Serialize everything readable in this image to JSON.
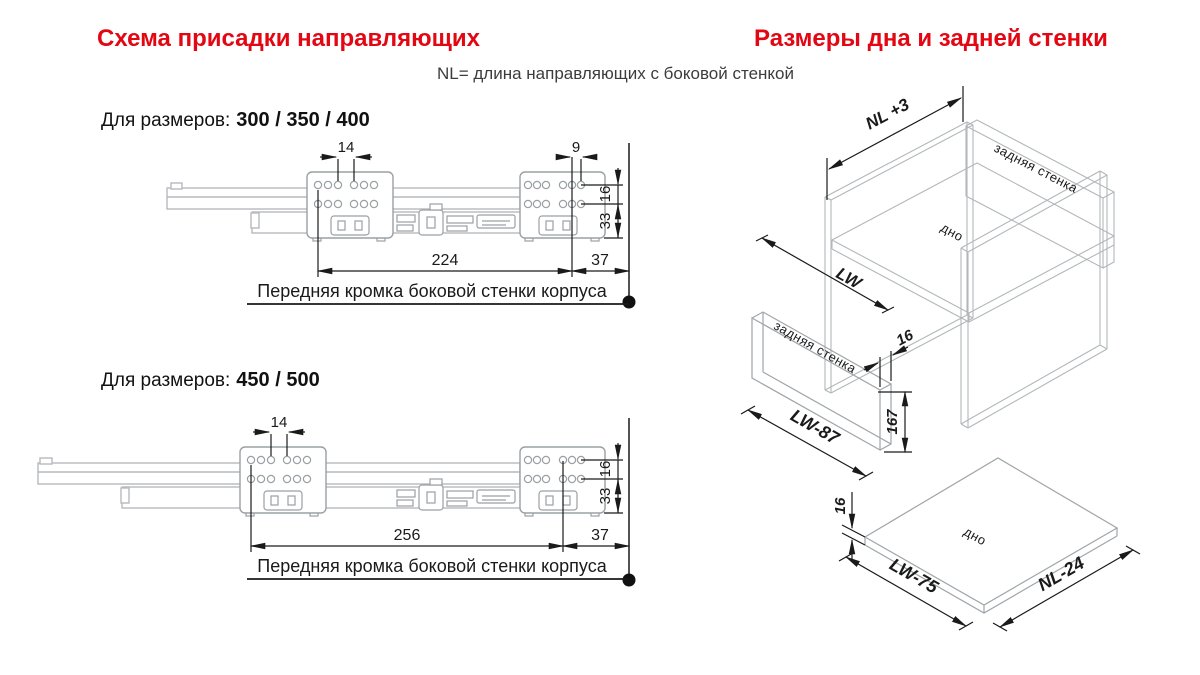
{
  "page": {
    "background": "#ffffff",
    "accent_red": "#e30613"
  },
  "header": {
    "left_title": "Схема присадки направляющих",
    "right_title": "Размеры дна и задней стенки",
    "subtitle": "NL= длина направляющих с боковой стенкой"
  },
  "diagram1": {
    "size_prefix": "Для размеров:",
    "size_values": "300 / 350 / 400",
    "dims": {
      "hole_pitch": "14",
      "hole_pitch_rear": "9",
      "v16": "16",
      "v33": "33",
      "length": "224",
      "front_offset": "37"
    },
    "note": "Передняя кромка боковой стенки корпуса"
  },
  "diagram2": {
    "size_prefix": "Для размеров:",
    "size_values": "450 / 500",
    "dims": {
      "hole_pitch": "14",
      "v16": "16",
      "v33": "33",
      "length": "256",
      "front_offset": "37"
    },
    "note": "Передняя кромка боковой стенки корпуса"
  },
  "iso": {
    "cabinet": {
      "depth_dim": "NL +3",
      "width_dim": "LW",
      "back_label": "задняя стенка",
      "bottom_label": "дно"
    },
    "back_panel": {
      "label": "задняя стенка",
      "width_dim": "LW-87",
      "height_dim": "167",
      "thickness_dim": "16"
    },
    "bottom_panel": {
      "label": "дно",
      "width_dim": "LW-75",
      "depth_dim": "NL-24",
      "thickness_dim": "16"
    }
  }
}
